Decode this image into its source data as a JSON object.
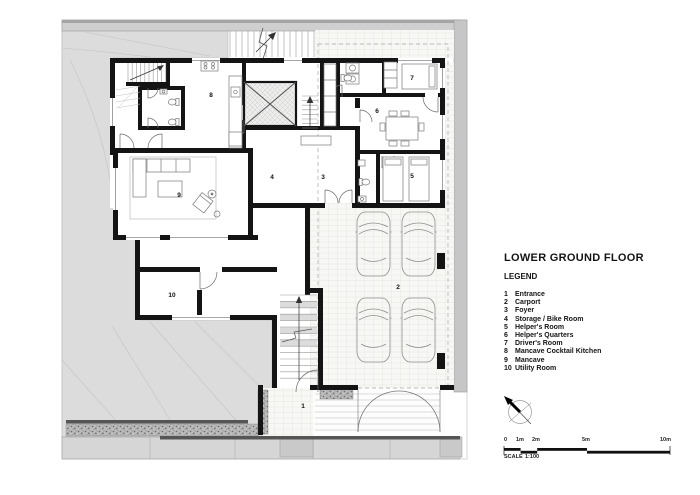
{
  "title": "LOWER GROUND FLOOR",
  "legend": {
    "heading": "LEGEND",
    "items": [
      {
        "num": "1",
        "label": "Entrance"
      },
      {
        "num": "2",
        "label": "Carport"
      },
      {
        "num": "3",
        "label": "Foyer"
      },
      {
        "num": "4",
        "label": "Storage / Bike Room"
      },
      {
        "num": "5",
        "label": "Helper's Room"
      },
      {
        "num": "6",
        "label": "Helper's Quarters"
      },
      {
        "num": "7",
        "label": "Driver's Room"
      },
      {
        "num": "8",
        "label": "Mancave Cocktail Kitchen"
      },
      {
        "num": "9",
        "label": "Mancave"
      },
      {
        "num": "10",
        "label": "Utility Room"
      }
    ]
  },
  "plan": {
    "markers": [
      "1",
      "2",
      "3",
      "4",
      "5",
      "6",
      "7",
      "8",
      "9",
      "10"
    ],
    "icons": {
      "north_arrow": "north-arrow-compass"
    }
  },
  "scale": {
    "ticks": [
      "0",
      "1m",
      "2m",
      "5m",
      "10m"
    ],
    "label": "SCALE",
    "ratio": "1:100"
  },
  "colors": {
    "wall": "#141414",
    "terrain": "#dcdcdc",
    "paving": "#f7f7f5",
    "site_band": "#c9c9c9"
  }
}
